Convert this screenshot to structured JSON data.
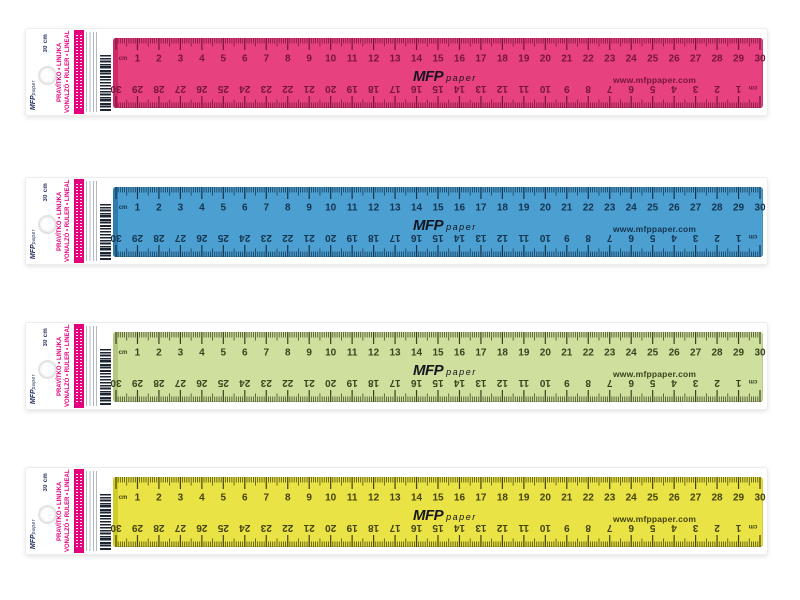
{
  "brand": {
    "logo_text": "MFP",
    "logo_suffix": "paper",
    "website": "www.mfppaper.com"
  },
  "packaging": {
    "length_label": "30 cm",
    "product_name_line1": "PRAVÍTKO • LINIJKA",
    "product_name_line2": "VONALZÓ • RULER • LINEAL",
    "stripe_color": "#E4007C"
  },
  "ruler": {
    "unit_label": "cm",
    "length_cm": 30,
    "top_scale_direction": "1 to 30, left to right",
    "bottom_scale_direction": "30 to 1, numbers inverted (zero at right end)"
  },
  "products": [
    {
      "color_name": "pink",
      "body": "#E8417F",
      "mark": "#74163E",
      "edge": "#CE2A68"
    },
    {
      "color_name": "blue",
      "body": "#4C9FD1",
      "mark": "#15344E",
      "edge": "#2E7CB0"
    },
    {
      "color_name": "green",
      "body": "#CFDF9D",
      "mark": "#39441E",
      "edge": "#B5C87D"
    },
    {
      "color_name": "yellow",
      "body": "#E9E345",
      "mark": "#45420F",
      "edge": "#D2CC27"
    }
  ]
}
